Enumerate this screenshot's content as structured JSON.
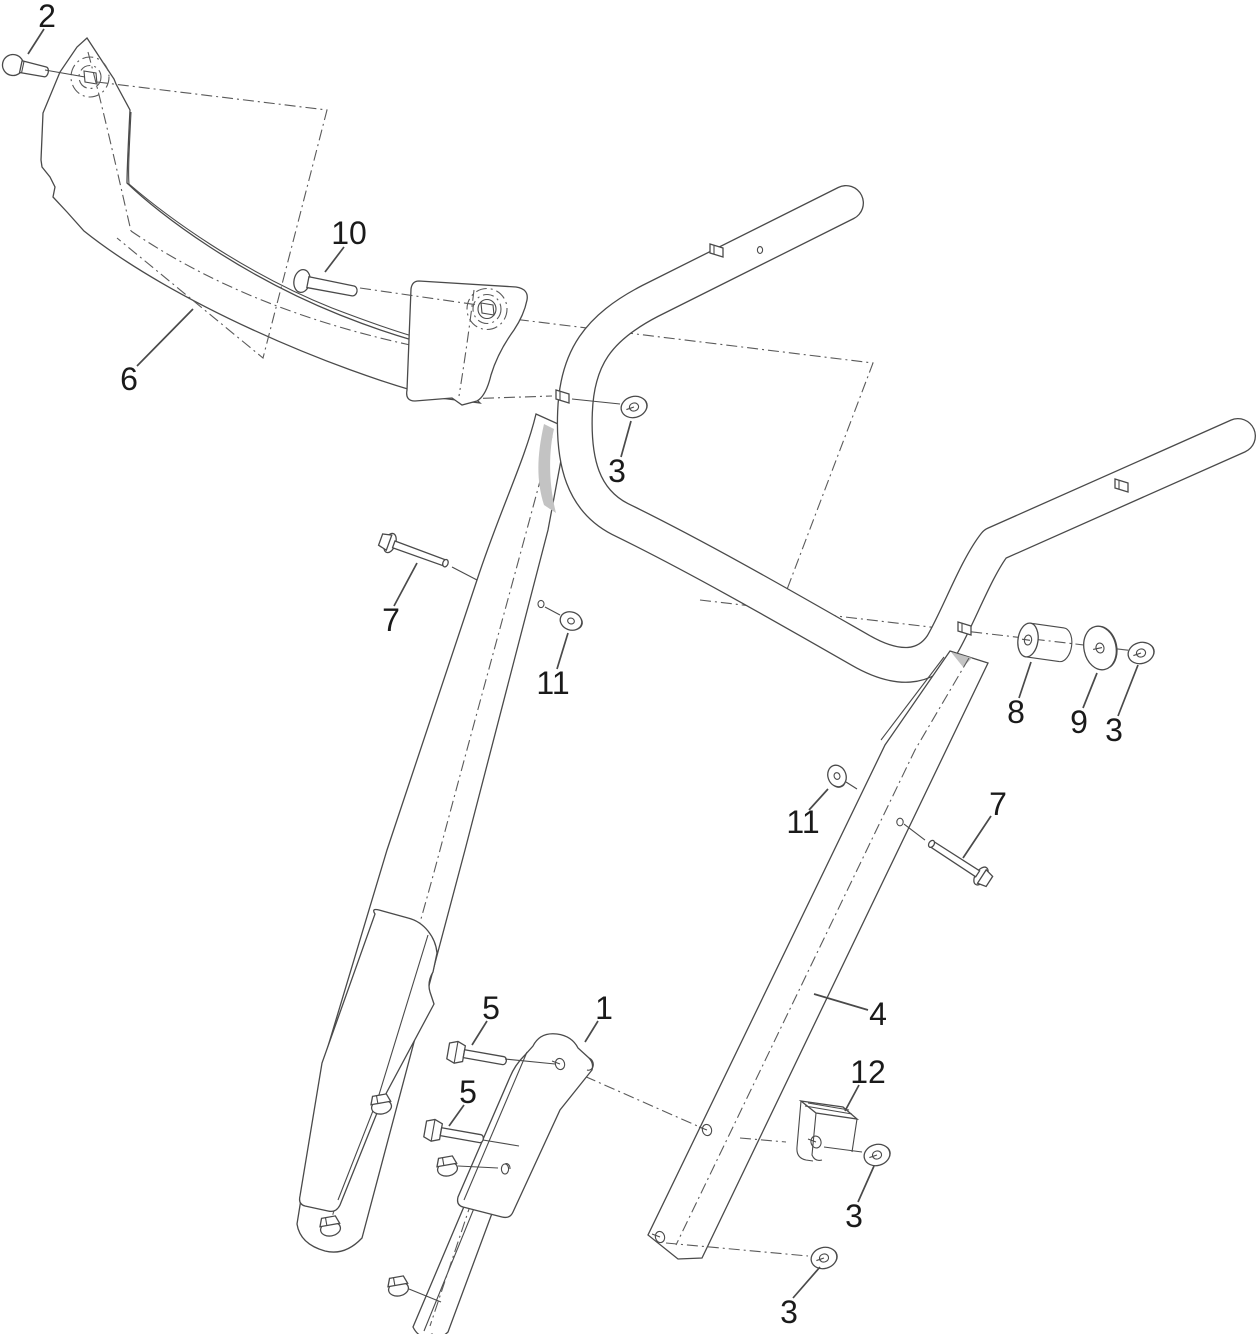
{
  "diagram": {
    "background": "#ffffff",
    "line_color": "#4a4a4a",
    "label_color": "#1a1a1a",
    "label_font_size": 32,
    "callouts": [
      {
        "label": "2",
        "tx": 47,
        "ty": 16,
        "x1": 44,
        "y1": 29,
        "x2": 28,
        "y2": 54
      },
      {
        "label": "10",
        "tx": 349,
        "ty": 233,
        "x1": 344,
        "y1": 247,
        "x2": 325,
        "y2": 272
      },
      {
        "label": "6",
        "tx": 129,
        "ty": 379,
        "x1": 137,
        "y1": 366,
        "x2": 193,
        "y2": 309
      },
      {
        "label": "3",
        "tx": 617,
        "ty": 471,
        "x1": 621,
        "y1": 457,
        "x2": 631,
        "y2": 421
      },
      {
        "label": "7",
        "tx": 391,
        "ty": 620,
        "x1": 394,
        "y1": 606,
        "x2": 417,
        "y2": 563
      },
      {
        "label": "11",
        "tx": 553,
        "ty": 683,
        "x1": 557,
        "y1": 669,
        "x2": 568,
        "y2": 633
      },
      {
        "label": "8",
        "tx": 1016,
        "ty": 712,
        "x1": 1019,
        "y1": 698,
        "x2": 1031,
        "y2": 662
      },
      {
        "label": "9",
        "tx": 1079,
        "ty": 722,
        "x1": 1083,
        "y1": 708,
        "x2": 1097,
        "y2": 673
      },
      {
        "label": "3",
        "tx": 1114,
        "ty": 730,
        "x1": 1118,
        "y1": 716,
        "x2": 1138,
        "y2": 665
      },
      {
        "label": "11",
        "tx": 803,
        "ty": 822,
        "x1": 809,
        "y1": 810,
        "x2": 828,
        "y2": 789
      },
      {
        "label": "7",
        "tx": 998,
        "ty": 804,
        "x1": 991,
        "y1": 816,
        "x2": 963,
        "y2": 858
      },
      {
        "label": "5",
        "tx": 491,
        "ty": 1008,
        "x1": 487,
        "y1": 1021,
        "x2": 472,
        "y2": 1045
      },
      {
        "label": "1",
        "tx": 604,
        "ty": 1008,
        "x1": 598,
        "y1": 1021,
        "x2": 585,
        "y2": 1042
      },
      {
        "label": "5",
        "tx": 468,
        "ty": 1092,
        "x1": 464,
        "y1": 1105,
        "x2": 449,
        "y2": 1126
      },
      {
        "label": "4",
        "tx": 878,
        "ty": 1014,
        "x1": 868,
        "y1": 1010,
        "x2": 814,
        "y2": 994
      },
      {
        "label": "12",
        "tx": 868,
        "ty": 1072,
        "x1": 859,
        "y1": 1085,
        "x2": 845,
        "y2": 1111
      },
      {
        "label": "3",
        "tx": 854,
        "ty": 1216,
        "x1": 858,
        "y1": 1202,
        "x2": 874,
        "y2": 1166
      },
      {
        "label": "3",
        "tx": 789,
        "ty": 1312,
        "x1": 793,
        "y1": 1298,
        "x2": 820,
        "y2": 1267
      }
    ]
  }
}
